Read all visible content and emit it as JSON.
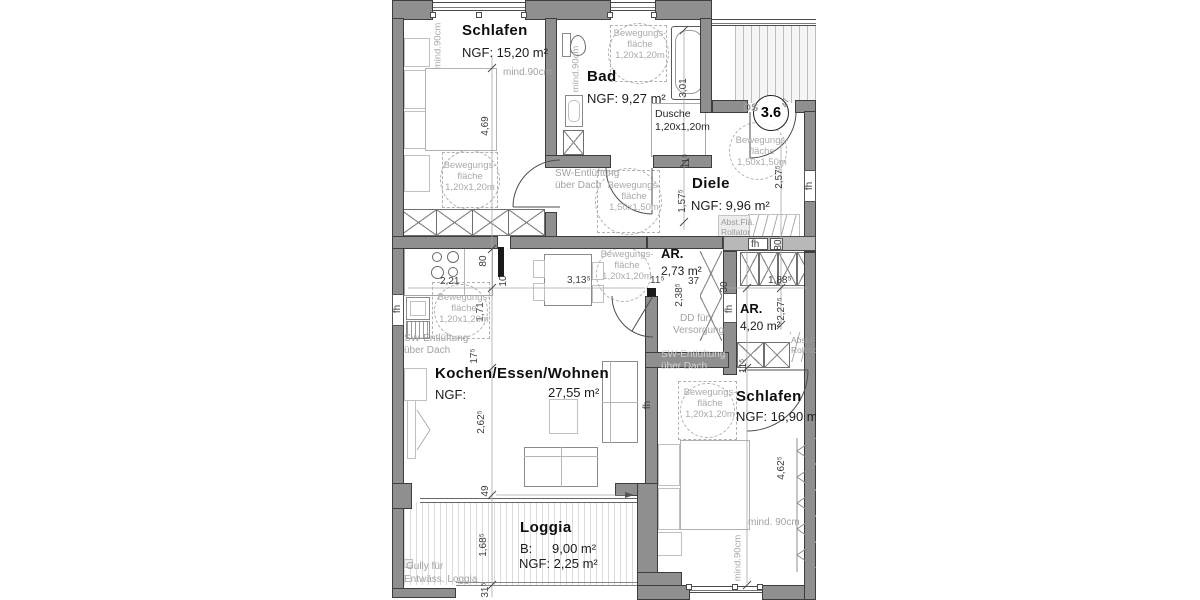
{
  "unit": {
    "number": "3.6",
    "door_label": "DS"
  },
  "rooms": [
    {
      "name": "Schlafen",
      "area": "NGF: 15,20 m²"
    },
    {
      "name": "Bad",
      "area": "NGF: 9,27 m²"
    },
    {
      "name": "Diele",
      "area": "NGF: 9,96 m²"
    },
    {
      "name": "AR.",
      "area": "2,73 m²"
    },
    {
      "name": "AR.",
      "area": "4,20 m²"
    },
    {
      "name": "Kochen/Essen/Wohnen",
      "area": "NGF: 27,55 m²"
    },
    {
      "name": "Schlafen",
      "area": "NGF: 16,90 m²"
    },
    {
      "name": "Loggia",
      "area_b": "B: 9,00 m²",
      "area_ngf": "NGF: 2,25 m²"
    }
  ],
  "colors": {
    "wall": "#8f8f8f",
    "wall_dark": "#3d3d3d",
    "wall_light": "#b8b8b8",
    "dim_text": "#3c3c3c",
    "gray_text": "#a2a2a2"
  },
  "annotations": [
    {
      "n": "room-title-schlafen-1",
      "t": "Schlafen",
      "c": "t",
      "x": 70,
      "y": 23
    },
    {
      "n": "room-area-schlafen-1",
      "t": "NGF: 15,20 m²",
      "c": "a",
      "x": 70,
      "y": 46
    },
    {
      "n": "room-title-bad",
      "t": "Bad",
      "c": "t",
      "x": 195,
      "y": 69
    },
    {
      "n": "room-area-bad",
      "t": "NGF: 9,27 m²",
      "c": "a",
      "x": 195,
      "y": 92
    },
    {
      "n": "room-title-diele",
      "t": "Diele",
      "c": "t",
      "x": 300,
      "y": 176
    },
    {
      "n": "room-area-diele",
      "t": "NGF: 9,96 m²",
      "c": "a",
      "x": 299,
      "y": 199
    },
    {
      "n": "room-title-ar-1",
      "t": "AR.",
      "c": "t2",
      "x": 269,
      "y": 247
    },
    {
      "n": "room-area-ar-1",
      "t": "2,73 m²",
      "c": "a2",
      "x": 269,
      "y": 265
    },
    {
      "n": "room-title-ar-2",
      "t": "AR.",
      "c": "t2",
      "x": 348,
      "y": 302
    },
    {
      "n": "room-area-ar-2",
      "t": "4,20 m²",
      "c": "a2",
      "x": 348,
      "y": 320
    },
    {
      "n": "room-title-wohnen",
      "t": "Kochen/Essen/Wohnen",
      "c": "t",
      "x": 43,
      "y": 366
    },
    {
      "n": "room-area-wohnen-ngf",
      "t": "NGF:",
      "c": "a",
      "x": 43,
      "y": 388
    },
    {
      "n": "room-area-wohnen-value",
      "t": "27,55 m²",
      "c": "a",
      "x": 156,
      "y": 386
    },
    {
      "n": "room-title-schlafen-2",
      "t": "Schlafen",
      "c": "t",
      "x": 344,
      "y": 389
    },
    {
      "n": "room-area-schlafen-2",
      "t": "NGF: 16,90 m²",
      "c": "a",
      "x": 344,
      "y": 410
    },
    {
      "n": "room-title-loggia",
      "t": "Loggia",
      "c": "t",
      "x": 128,
      "y": 520
    },
    {
      "n": "room-area-loggia-b-label",
      "t": "B:",
      "c": "a",
      "x": 128,
      "y": 542
    },
    {
      "n": "room-area-loggia-b-value",
      "t": "9,00 m²",
      "c": "a",
      "x": 160,
      "y": 542
    },
    {
      "n": "room-area-loggia-ngf",
      "t": "NGF: 2,25 m²",
      "c": "a",
      "x": 127,
      "y": 557
    },
    {
      "n": "unit-number-badge",
      "t": "3.6",
      "c": "big",
      "x": 361,
      "y": 95
    },
    {
      "n": "entrance-door-label",
      "t": "DS",
      "c": "ds",
      "x": 351,
      "y": 103
    },
    {
      "n": "dim-47",
      "t": "47",
      "c": "dvs",
      "x": 394,
      "y": 103
    },
    {
      "n": "dim-2-21",
      "t": "2,21",
      "c": "d",
      "x": 48,
      "y": 277
    },
    {
      "n": "dim-3-13",
      "t": "3,13⁵",
      "c": "d",
      "x": 175,
      "y": 276
    },
    {
      "n": "dim-11-ar1",
      "t": "11⁵",
      "c": "d",
      "x": 258,
      "y": 276
    },
    {
      "n": "dim-37",
      "t": "37",
      "c": "d",
      "x": 296,
      "y": 277
    },
    {
      "n": "dim-1-88",
      "t": "1,88⁵",
      "c": "d",
      "x": 376,
      "y": 276
    },
    {
      "n": "dim-4-69",
      "t": "4,69",
      "c": "dv",
      "x": 94,
      "y": 126
    },
    {
      "n": "dim-3-01",
      "t": "3,01",
      "c": "dv",
      "x": 292,
      "y": 88
    },
    {
      "n": "dim-11-bad",
      "t": "11⁵",
      "c": "dv",
      "x": 295,
      "y": 161
    },
    {
      "n": "dim-1-57",
      "t": "1,57⁵",
      "c": "dv",
      "x": 291,
      "y": 201
    },
    {
      "n": "dim-2-57",
      "t": "2,57⁵",
      "c": "dv",
      "x": 388,
      "y": 177
    },
    {
      "n": "dim-80-kitchen",
      "t": "80",
      "c": "dv",
      "x": 92,
      "y": 261
    },
    {
      "n": "dim-10",
      "t": "10",
      "c": "dv",
      "x": 112,
      "y": 281
    },
    {
      "n": "dim-1-71",
      "t": "1,71",
      "c": "dv",
      "x": 89,
      "y": 312
    },
    {
      "n": "dim-17",
      "t": "17⁵",
      "c": "dv",
      "x": 83,
      "y": 356
    },
    {
      "n": "dim-2-62",
      "t": "2,62⁵",
      "c": "dv",
      "x": 90,
      "y": 422
    },
    {
      "n": "dim-49",
      "t": "49",
      "c": "dv",
      "x": 94,
      "y": 491
    },
    {
      "n": "dim-1-68",
      "t": "1,68⁵",
      "c": "dv",
      "x": 92,
      "y": 545
    },
    {
      "n": "dim-31",
      "t": "31⁵",
      "c": "dv",
      "x": 94,
      "y": 590
    },
    {
      "n": "dim-2-38",
      "t": "2,38⁵",
      "c": "dv",
      "x": 288,
      "y": 295
    },
    {
      "n": "dim-30",
      "t": "30",
      "c": "dv",
      "x": 333,
      "y": 287
    },
    {
      "n": "dim-2-27",
      "t": "2,27⁵",
      "c": "dv",
      "x": 390,
      "y": 309
    },
    {
      "n": "dim-80-ar2",
      "t": "80",
      "c": "dv",
      "x": 387,
      "y": 245
    },
    {
      "n": "dim-11-schlafen2",
      "t": "11⁵",
      "c": "dv",
      "x": 352,
      "y": 366
    },
    {
      "n": "dim-4-62",
      "t": "4,62⁵",
      "c": "dv",
      "x": 390,
      "y": 468
    },
    {
      "n": "window-label-fh-left",
      "t": "fh",
      "c": "dv",
      "x": 6,
      "y": 309
    },
    {
      "n": "window-label-fh-wohnen",
      "t": "fh",
      "c": "dv",
      "x": 256,
      "y": 405
    },
    {
      "n": "window-label-fh-right",
      "t": "fh",
      "c": "dv",
      "x": 418,
      "y": 186
    },
    {
      "n": "window-label-fh-party",
      "t": "fh",
      "c": "dv",
      "x": 338,
      "y": 309
    },
    {
      "n": "window-label-fh-diele",
      "t": "fh",
      "c": "d",
      "x": 359,
      "y": 240
    },
    {
      "n": "note-mind90-schlafen1-v",
      "t": "mind.90cm",
      "c": "gv",
      "x": 46,
      "y": 46
    },
    {
      "n": "note-mind90-schlafen1-h",
      "t": "mind.90cm",
      "c": "g",
      "x": 111,
      "y": 68
    },
    {
      "n": "note-mind90-bad",
      "t": "mind.90cm",
      "c": "gv",
      "x": 184,
      "y": 69
    },
    {
      "n": "note-mind90-schlafen2-h",
      "t": "mind. 90cm",
      "c": "g",
      "x": 356,
      "y": 518
    },
    {
      "n": "note-mind90-schlafen2-v",
      "t": "mind.90cm",
      "c": "gv",
      "x": 346,
      "y": 558
    },
    {
      "n": "bew-schlafen1-line1",
      "t": "Bewegungs-",
      "c": "gc",
      "x": 46,
      "y": 161,
      "w": 64
    },
    {
      "n": "bew-schlafen1-line2",
      "t": "fläche",
      "c": "gc",
      "x": 46,
      "y": 172,
      "w": 64
    },
    {
      "n": "bew-schlafen1-line3",
      "t": "1,20x1,20m",
      "c": "gc",
      "x": 46,
      "y": 183,
      "w": 64
    },
    {
      "n": "bew-bad-line1",
      "t": "Bewegungs-",
      "c": "gc",
      "x": 216,
      "y": 29,
      "w": 64
    },
    {
      "n": "bew-bad-line2",
      "t": "fläche",
      "c": "gc",
      "x": 216,
      "y": 40,
      "w": 64
    },
    {
      "n": "bew-bad-line3",
      "t": "1,20x1,20m",
      "c": "gc",
      "x": 216,
      "y": 51,
      "w": 64
    },
    {
      "n": "bew-kueche-line1",
      "t": "Bewegungs-",
      "c": "gc",
      "x": 40,
      "y": 293,
      "w": 64
    },
    {
      "n": "bew-kueche-line2",
      "t": "fläche",
      "c": "gc",
      "x": 40,
      "y": 304,
      "w": 64
    },
    {
      "n": "bew-kueche-line3",
      "t": "1,20x1,20m",
      "c": "gc",
      "x": 40,
      "y": 315,
      "w": 64
    },
    {
      "n": "bew-diele-low-line1",
      "t": "Bewegungs-",
      "c": "gc",
      "x": 208,
      "y": 181,
      "w": 68
    },
    {
      "n": "bew-diele-low-line2",
      "t": "fläche",
      "c": "gc",
      "x": 208,
      "y": 192,
      "w": 68
    },
    {
      "n": "bew-diele-low-line3",
      "t": "1,50x1,50m",
      "c": "gc",
      "x": 208,
      "y": 203,
      "w": 68
    },
    {
      "n": "bew-diele-up-line1",
      "t": "Bewegungs-",
      "c": "gc",
      "x": 336,
      "y": 136,
      "w": 68
    },
    {
      "n": "bew-diele-up-line2",
      "t": "fläche",
      "c": "gc",
      "x": 336,
      "y": 147,
      "w": 68
    },
    {
      "n": "bew-diele-up-line3",
      "t": "1,50x1,50m",
      "c": "gc",
      "x": 336,
      "y": 158,
      "w": 68
    },
    {
      "n": "bew-wohnen-line1",
      "t": "Bewegungs-",
      "c": "gc",
      "x": 203,
      "y": 250,
      "w": 64
    },
    {
      "n": "bew-wohnen-line2",
      "t": "fläche",
      "c": "gc",
      "x": 203,
      "y": 261,
      "w": 64
    },
    {
      "n": "bew-wohnen-line3",
      "t": "1,20x1,20m",
      "c": "gc",
      "x": 203,
      "y": 272,
      "w": 64
    },
    {
      "n": "bew-schlafen2-line1",
      "t": "Bewegungs-",
      "c": "gc",
      "x": 285,
      "y": 388,
      "w": 66
    },
    {
      "n": "bew-schlafen2-line2",
      "t": "fläche",
      "c": "gc",
      "x": 285,
      "y": 399,
      "w": 66
    },
    {
      "n": "bew-schlafen2-line3",
      "t": "1,20x1,20m",
      "c": "gc",
      "x": 285,
      "y": 410,
      "w": 66
    },
    {
      "n": "note-sw-kitchen-1",
      "t": "SW-Entlüftung",
      "c": "g",
      "x": 12,
      "y": 334
    },
    {
      "n": "note-sw-kitchen-2",
      "t": "über Dach",
      "c": "g",
      "x": 12,
      "y": 346
    },
    {
      "n": "note-sw-bad-1",
      "t": "SW-Entlüftung",
      "c": "g",
      "x": 163,
      "y": 169
    },
    {
      "n": "note-sw-bad-2",
      "t": "über Dach",
      "c": "g",
      "x": 163,
      "y": 181
    },
    {
      "n": "note-sw-right-1",
      "t": "SW-Entlüftung",
      "c": "gw",
      "x": 269,
      "y": 350
    },
    {
      "n": "note-sw-right-2",
      "t": "über Dach",
      "c": "gw",
      "x": 269,
      "y": 362
    },
    {
      "n": "note-dd-1",
      "t": "DD für",
      "c": "g",
      "x": 288,
      "y": 314
    },
    {
      "n": "note-dd-2",
      "t": "Versorgung",
      "c": "g",
      "x": 281,
      "y": 326
    },
    {
      "n": "note-abst-diele-1",
      "t": "Abst.Flä.",
      "c": "gs",
      "x": 329,
      "y": 218
    },
    {
      "n": "note-abst-diele-2",
      "t": "Rollator",
      "c": "gs",
      "x": 329,
      "y": 228
    },
    {
      "n": "note-abst-ar2-1",
      "t": "Abst.Flä",
      "c": "gs",
      "x": 399,
      "y": 336
    },
    {
      "n": "note-abst-ar2-2",
      "t": "Rollator",
      "c": "gs",
      "x": 399,
      "y": 346
    },
    {
      "n": "note-gully-1",
      "t": "Gully für",
      "c": "g",
      "x": 14,
      "y": 562
    },
    {
      "n": "note-gully-2",
      "t": "Entwäss. Loggia",
      "c": "g",
      "x": 12,
      "y": 575
    },
    {
      "n": "note-dusche-1",
      "t": "Dusche",
      "c": "dk",
      "x": 263,
      "y": 109
    },
    {
      "n": "note-dusche-2",
      "t": "1,20x1,20m",
      "c": "dk",
      "x": 263,
      "y": 122
    }
  ]
}
